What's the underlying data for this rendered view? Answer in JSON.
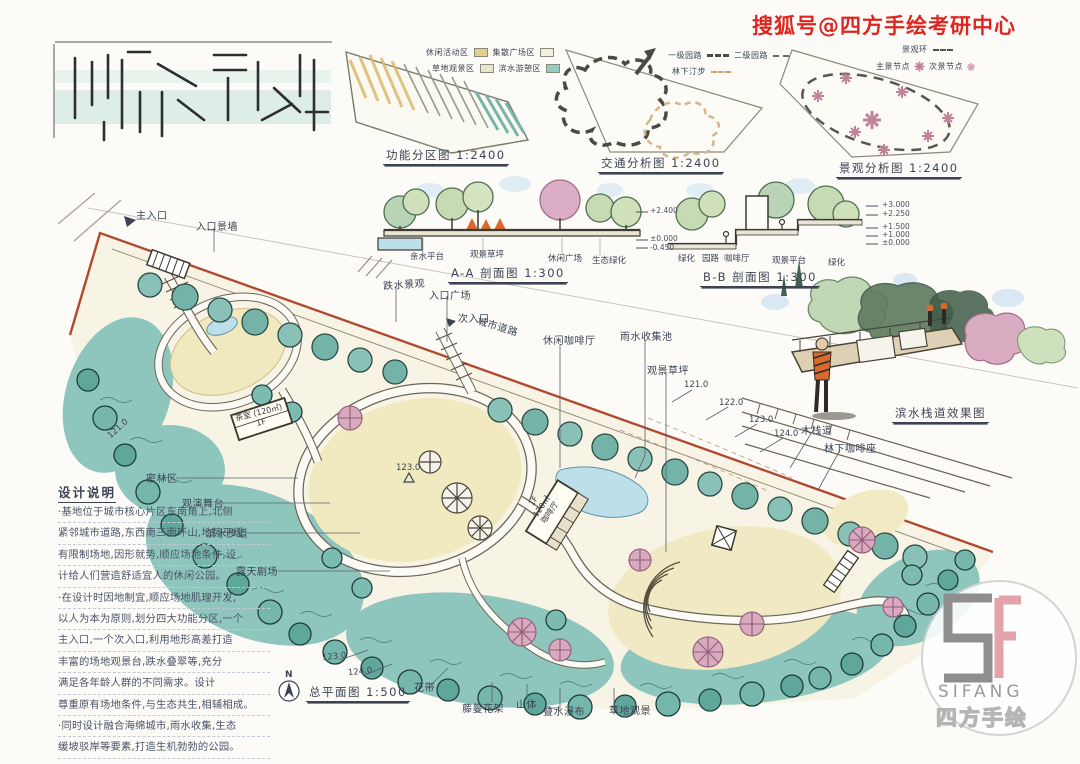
{
  "watermark": {
    "text": "搜狐号@四方手绘考研中心"
  },
  "colors": {
    "watermark_red": "#e0251f",
    "site_boundary_red": "#b2492f",
    "tree_teal": "#8cc4bd",
    "water_blue": "#bcdfe9",
    "lawn_cream": "#f0e9c2",
    "blossom_pink": "#d9a9bd",
    "logo_gray": "#8e8e8e",
    "logo_pink": "#e4a3a8"
  },
  "diagrams": {
    "function": {
      "caption": "功能分区图 1:2400",
      "legend": [
        {
          "label": "休闲活动区",
          "color": "#e3cf8f"
        },
        {
          "label": "集散广场区",
          "color": "#f3efe1"
        },
        {
          "label": "草地观景区",
          "color": "#ece5cc"
        },
        {
          "label": "滨水游憩区",
          "color": "#96ccc2"
        }
      ]
    },
    "traffic": {
      "caption": "交通分析图 1:2400",
      "legend": [
        {
          "label": "一级园路"
        },
        {
          "label": "二级园路"
        },
        {
          "label": "林下汀步"
        }
      ]
    },
    "view": {
      "caption": "景观分析图 1:2400",
      "legend": [
        {
          "label": "景观环"
        },
        {
          "label": "主景节点"
        },
        {
          "label": "次景节点"
        }
      ]
    }
  },
  "sections": {
    "aa": {
      "caption": "A-A 剖面图 1:300",
      "labels": [
        "亲水平台",
        "观景草坪",
        "休闲广场",
        "生态绿化"
      ],
      "elevations": [
        "+2.400",
        "±0.000",
        "-0.450"
      ]
    },
    "bb": {
      "caption": "B-B 剖面图 1:300",
      "labels": [
        "绿化",
        "园路",
        "咖啡厅",
        "观景平台",
        "绿化"
      ],
      "elevations": [
        "+3.000",
        "+2.250",
        "+1.500",
        "+1.000",
        "±0.000"
      ]
    }
  },
  "perspective": {
    "caption": "滨水栈道效果图"
  },
  "plan": {
    "caption": "总平面图 1:500",
    "north": "N",
    "labels": [
      {
        "text": "主入口"
      },
      {
        "text": "入口景墙"
      },
      {
        "text": "跌水景观"
      },
      {
        "text": "入口广场"
      },
      {
        "text": "次入口"
      },
      {
        "text": "城市道路"
      },
      {
        "text": "休闲咖啡厅"
      },
      {
        "text": "雨水收集池"
      },
      {
        "text": "观景草坪"
      },
      {
        "text": "121.0"
      },
      {
        "text": "122.0"
      },
      {
        "text": "123.0"
      },
      {
        "text": "124.0"
      },
      {
        "text": "木栈道"
      },
      {
        "text": "林下咖啡座"
      },
      {
        "text": "121.0"
      },
      {
        "text": "密林区"
      },
      {
        "text": "观演舞台"
      },
      {
        "text": "滨水步道"
      },
      {
        "text": "露天剧场"
      },
      {
        "text": "花带"
      },
      {
        "text": "藤蔓花架"
      },
      {
        "text": "山体"
      },
      {
        "text": "叠水瀑布"
      },
      {
        "text": "草地观景"
      },
      {
        "text": "123.0"
      },
      {
        "text": "124.0"
      },
      {
        "text": "123.0"
      }
    ],
    "buildings": {
      "cafe_lines": [
        "1F",
        "120㎡",
        "咖啡厅"
      ],
      "tea_name": "茶室 (120㎡)",
      "tea_floor": "1F"
    }
  },
  "notes": {
    "title": "设计说明",
    "lines": [
      "·基地位于城市核心片区东南角上,北侧",
      "紧邻城市道路,东西南三面环山,地势平缓",
      "有限制场地,因形就势,顺应场地条件,设",
      "计给人们营造舒适宜人的休闲公园。",
      "·在设计时因地制宜,顺应场地肌理开发,",
      "以人为本为原则,划分四大功能分区,一个",
      "主入口,一个次入口,利用地形高差打造",
      "丰富的场地观景台,跌水叠翠等,充分",
      "满足各年龄人群的不同需求。设计",
      "尊重原有场地条件,与生态共生,相辅相成。",
      "·同时设计融合海绵城市,雨水收集,生态",
      "缓坡驳岸等要素,打造生机勃勃的公园。"
    ]
  },
  "logo": {
    "latin": "SIFANG",
    "cn": "四方手绘"
  }
}
